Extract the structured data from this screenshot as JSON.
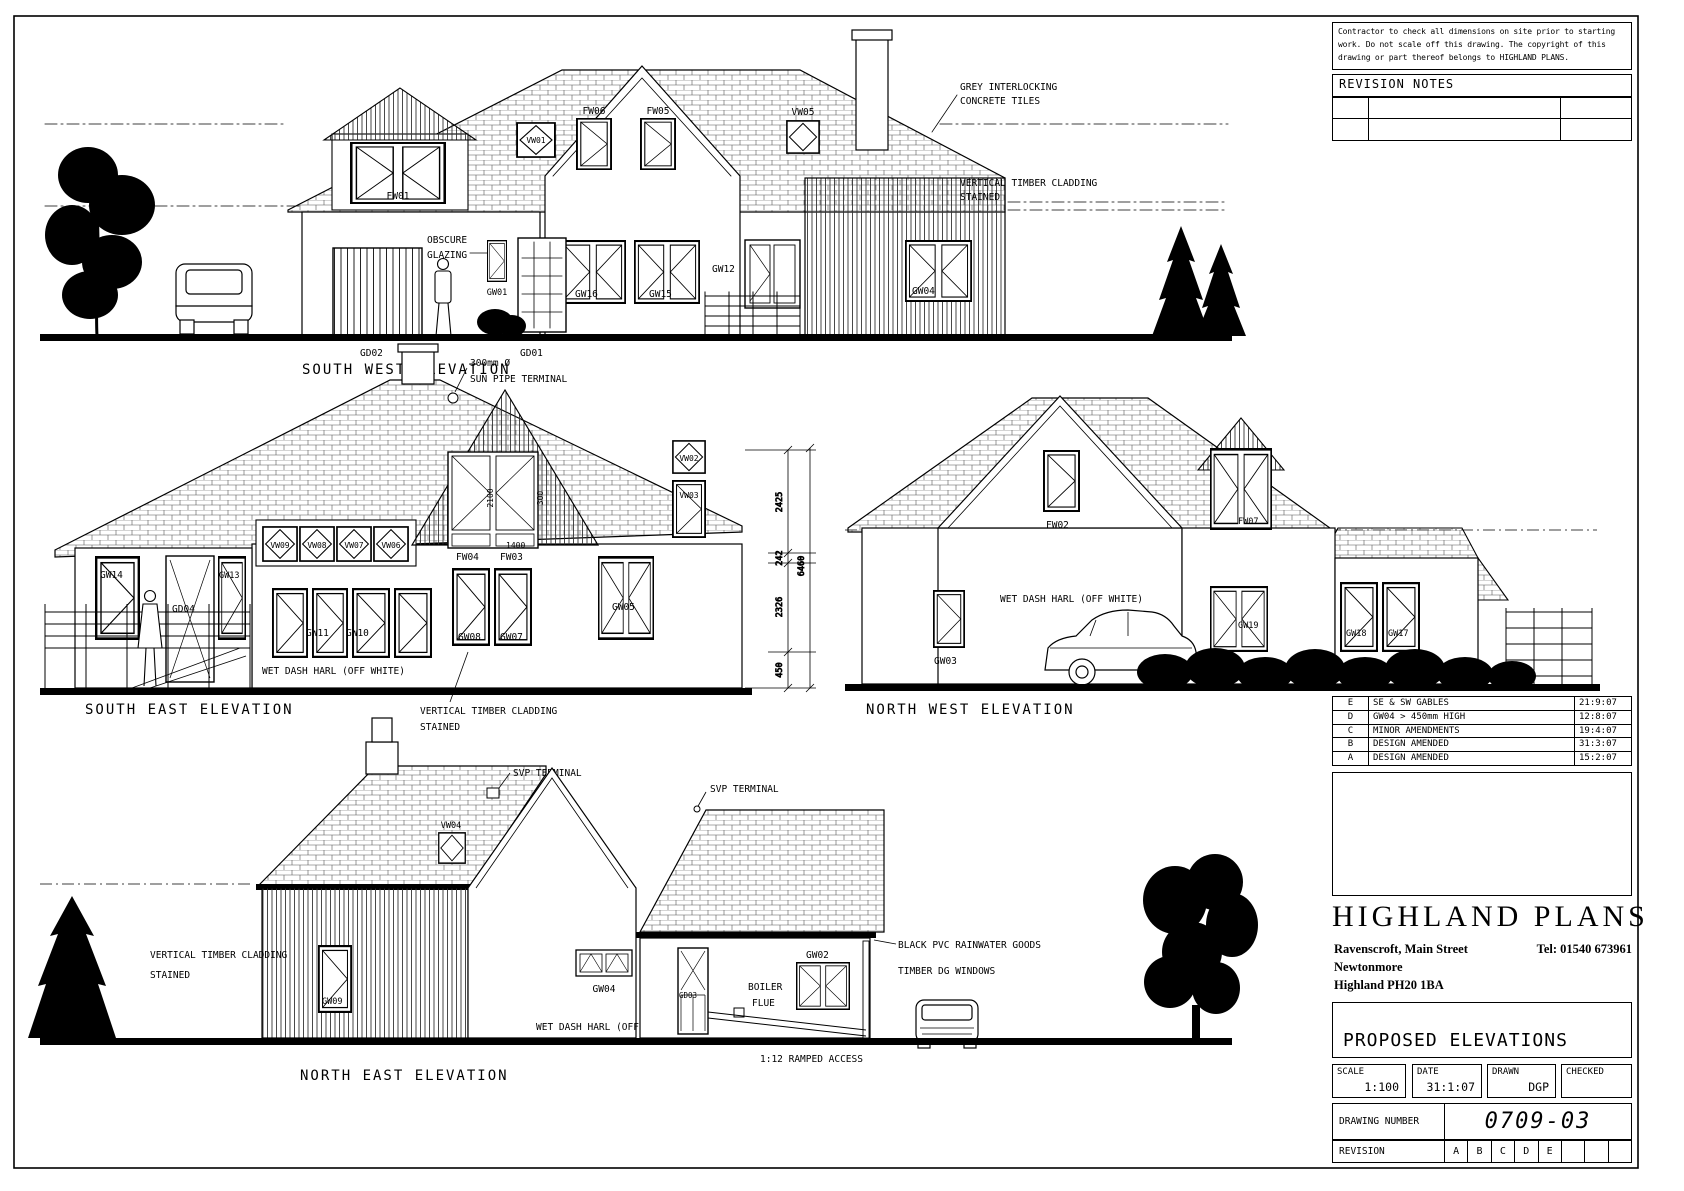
{
  "notes": {
    "disclaimer_l1": "Contractor to check all dimensions on site prior to starting",
    "disclaimer_l2": "work. Do not scale off this drawing. The copyright of this",
    "disclaimer_l3": "drawing or part thereof belongs to HIGHLAND PLANS.",
    "revision_notes_title": "REVISION NOTES"
  },
  "revisions": [
    {
      "code": "E",
      "note": "SE & SW GABLES",
      "date": "21:9:07"
    },
    {
      "code": "D",
      "note": "GW04 > 450mm HIGH",
      "date": "12:8:07"
    },
    {
      "code": "C",
      "note": "MINOR AMENDMENTS",
      "date": "19:4:07"
    },
    {
      "code": "B",
      "note": "DESIGN AMENDED",
      "date": "31:3:07"
    },
    {
      "code": "A",
      "note": "DESIGN AMENDED",
      "date": "15:2:07"
    }
  ],
  "title_block": {
    "company": "HIGHLAND PLANS",
    "address_line1": "Ravenscroft, Main Street",
    "address_line2": "Newtonmore",
    "address_line3": "Highland PH20 1BA",
    "tel": "Tel:  01540 673961",
    "drawing_title": "PROPOSED ELEVATIONS",
    "scale_label": "SCALE",
    "scale_value": "1:100",
    "date_label": "DATE",
    "date_value": "31:1:07",
    "drawn_label": "DRAWN",
    "drawn_value": "DGP",
    "checked_label": "CHECKED",
    "checked_value": "",
    "drawing_number_label": "DRAWING NUMBER",
    "drawing_number": "0709-03",
    "revision_label": "REVISION",
    "revision_cells": [
      "A",
      "B",
      "C",
      "D",
      "E",
      "",
      "",
      ""
    ]
  },
  "elevations": {
    "south_west": {
      "title": "SOUTH WEST ELEVATION",
      "notes": {
        "tiles_1": "GREY INTERLOCKING",
        "tiles_2": "CONCRETE TILES",
        "clad_1": "VERTICAL TIMBER CLADDING",
        "clad_2": "STAINED",
        "obscure_1": "OBSCURE",
        "obscure_2": "GLAZING"
      },
      "labels": {
        "fw01": "FW01",
        "vw01": "VW01",
        "fw06": "FW06",
        "fw05": "FW05",
        "vw05": "VW05",
        "gw01": "GW01",
        "gw16": "GW16",
        "gw15": "GW15",
        "gw12": "GW12",
        "gw04": "GW04",
        "gd02": "GD02",
        "gd01": "GD01"
      }
    },
    "south_east": {
      "title": "SOUTH EAST ELEVATION",
      "notes": {
        "sun_1": "300mm Ø",
        "sun_2": "SUN PIPE TERMINAL",
        "harl": "WET DASH HARL (OFF WHITE)",
        "clad_1": "VERTICAL TIMBER CLADDING",
        "clad_2": "STAINED"
      },
      "labels": {
        "vw09": "VW09",
        "vw08": "VW08",
        "vw07": "VW07",
        "vw06": "VW06",
        "gw14": "GW14",
        "gd04": "GD04",
        "gw13": "GW13",
        "gw11": "GW11",
        "gw10": "GW10",
        "fw04": "FW04",
        "fw03": "FW03",
        "gw08": "GW08",
        "gw07": "GW07",
        "gw05": "GW05",
        "vw02": "VW02",
        "vw03": "VW03",
        "dim_1400": "1400",
        "dim_2100": "2100",
        "dim_300": "300"
      },
      "dimensions": {
        "d1": "2425",
        "d2": "242",
        "d3": "2326",
        "d4": "450",
        "total": "6460"
      }
    },
    "north_west": {
      "title": "NORTH WEST ELEVATION",
      "notes": {
        "harl": "WET DASH HARL (OFF WHITE)"
      },
      "labels": {
        "fw02": "FW02",
        "fw07": "FW07",
        "gw03": "GW03",
        "gw19": "GW19",
        "gw18": "GW18",
        "gw17": "GW17"
      }
    },
    "north_east": {
      "title": "NORTH EAST ELEVATION",
      "notes": {
        "svp": "SVP TERMINAL",
        "clad_1": "VERTICAL TIMBER CLADDING",
        "clad_2": "STAINED",
        "harl": "WET DASH HARL (OFF WHITE)",
        "boiler_1": "BOILER",
        "boiler_2": "FLUE",
        "rainwater": "BLACK PVC RAINWATER GOODS",
        "timber_windows": "TIMBER DG WINDOWS",
        "ramp": "1:12 RAMPED ACCESS"
      },
      "labels": {
        "vw04": "VW04",
        "gw09": "GW09",
        "gw04": "GW04",
        "gd03": "GD03",
        "gw02": "GW02"
      }
    }
  }
}
